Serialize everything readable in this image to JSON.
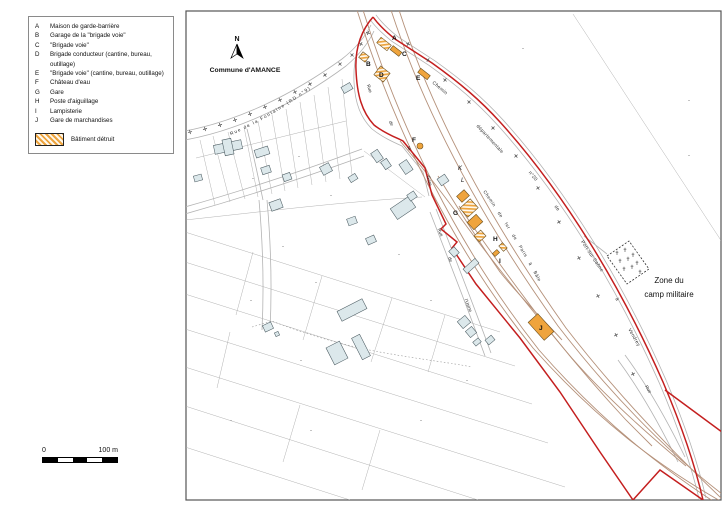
{
  "legend": {
    "items": [
      {
        "key": "A",
        "label": "Maison de garde-barrière"
      },
      {
        "key": "B",
        "label": "Garage de la \"brigade voie\""
      },
      {
        "key": "C",
        "label": "\"Brigade voie\""
      },
      {
        "key": "D",
        "label": "Brigade conducteur (cantine, bureau, outillage)"
      },
      {
        "key": "E",
        "label": "\"Brigade voie\" (cantine, bureau, outillage)"
      },
      {
        "key": "F",
        "label": "Château d'eau"
      },
      {
        "key": "G",
        "label": "Gare"
      },
      {
        "key": "H",
        "label": "Poste d'aiguillage"
      },
      {
        "key": "I",
        "label": "Lampisterie"
      },
      {
        "key": "J",
        "label": "Gare de marchandises"
      }
    ],
    "destroyed_label": "Bâtiment détruit"
  },
  "scalebar": {
    "start": "0",
    "end": "100 m"
  },
  "compass": {
    "north": "N"
  },
  "map": {
    "commune": "Commune d'AMANCE",
    "zone": {
      "line1": "Zone du",
      "line2": "camp militaire"
    },
    "markers": {
      "a": "A",
      "b": "B",
      "c": "C",
      "d": "D",
      "e": "E",
      "f": "F",
      "g": "G",
      "h": "H",
      "i": "I",
      "j": "J",
      "k": "K",
      "l": "L"
    },
    "streets": {
      "fontaine": "Rue de la Fontaine (RD n°9)",
      "rue": "Rue",
      "de": "de",
      "la": "la",
      "gare": "Gare",
      "rue2": "Rue",
      "de2": "de",
      "usine": "l'Usine",
      "rue3": "Rue",
      "railway": "Chemin de fer de Paris à Bâle",
      "chemin": "Chemin",
      "departementale": "départementale",
      "numero": "n°20",
      "de3": "de",
      "port": "Port-sur-Saône",
      "a": "à",
      "dest": "Vendrey"
    }
  },
  "colors": {
    "boundary_red": "#c41f1f",
    "building_orange": "#efa43d",
    "rail_brown": "#b5917a",
    "village_building": "#dce8eb",
    "road_gray": "#b3b3b3"
  }
}
